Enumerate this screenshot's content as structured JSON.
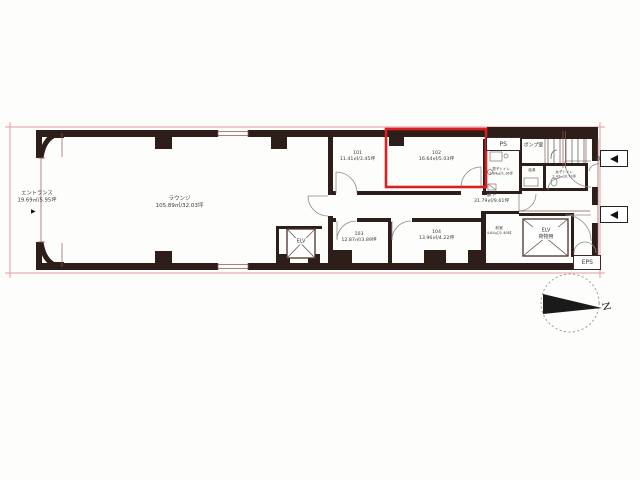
{
  "colors": {
    "wall": "#2e1e1a",
    "line": "#6b3a33",
    "boundary": "#e59c9c",
    "highlight": "#d92121",
    "text": "#3a3a3a"
  },
  "rooms": {
    "entrance": {
      "name": "エントランス",
      "area": "19.69㎡/5.95坪",
      "marker": "▶"
    },
    "lounge": {
      "name": "ラウンジ",
      "area": "105.89㎡/32.03坪"
    },
    "room101": {
      "number": "101",
      "area": "11.41㎡/3.45坪"
    },
    "room102": {
      "number": "102",
      "area": "16.64㎡/5.03坪",
      "highlighted": true
    },
    "room103": {
      "number": "103",
      "area": "12.87㎡/3.89坪"
    },
    "room104": {
      "number": "104",
      "area": "13.96㎡/4.22坪"
    },
    "corridor": {
      "name": "廊下",
      "area": "31.79㎡/9.61坪"
    },
    "pump_room": {
      "name": "ポンプ室"
    },
    "anteroom": {
      "name": "前室",
      "area": "4.64㎡/1.40坪"
    },
    "mens_toilet": {
      "name": "男子トイレ",
      "area": "3.84㎡/1.16坪"
    },
    "womens_toilet": {
      "name": "女子トイレ",
      "area": "2.43㎡/0.73坪"
    },
    "kitchenette": {
      "name": "給湯"
    }
  },
  "shafts": {
    "ps": {
      "label": "PS"
    },
    "eps": {
      "label": "EPS"
    },
    "elv_passenger": {
      "label": "ELV"
    },
    "elv_freight": {
      "label": "ELV",
      "sub": "荷物用"
    }
  },
  "annotations": {
    "stair_marker": "B",
    "compass_north": "N"
  }
}
